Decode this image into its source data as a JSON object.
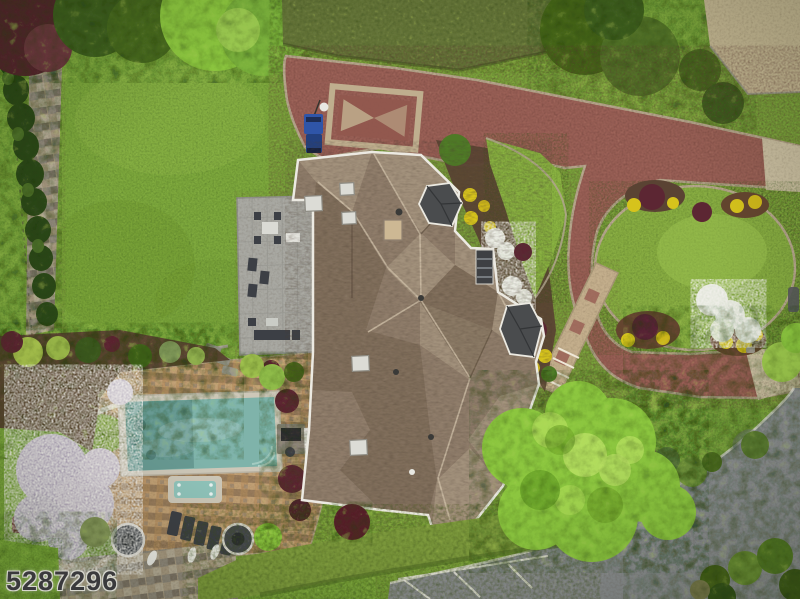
{
  "meta": {
    "type": "aerial-drone-photo",
    "subject": "top-down view of luxury home with complex hip roof, paver courtyard driveway, circular lawn island, swimming pool with spa, stone patio and landscaped grounds"
  },
  "watermark": {
    "text": "5287296"
  },
  "colors": {
    "lawn": "#7da73e",
    "island": "#87ac43",
    "hedge_top": "#66763a",
    "hedge_bottom": "#7d9a3c",
    "brick": "#9a6156",
    "paver_border": "#b8a88e",
    "gravel": "#c6b894",
    "pavement_tan": "#c9bda0",
    "asphalt": "#8a8d90",
    "road_marking": "#e8e6dc",
    "roof": "#8f7d6b",
    "roof_light": "#b3a28a",
    "roof_dark": "#6e5d4b",
    "trim": "#eceae2",
    "dormer": "#4a4c4e",
    "patio": "#a8a8a2",
    "mulch": "#5a4333",
    "pool_water": "#7fb3aa",
    "pool_coping": "#cdc7b8",
    "spa_water": "#8fc3ba",
    "deck": "#b6956a",
    "stone_path": "#a89a82",
    "shrub_maroon": "#5c2633",
    "shrub_yellow": "#d6c31c",
    "flower_white": "#e2e6da",
    "tree_bright": "#8cc63f",
    "tree_dark": "#3f6120",
    "conifer": "#2f4a1c",
    "furniture": "#3c3f45",
    "vehicle_blue": "#2f55a8",
    "white_pad": "#e9e7e0"
  }
}
